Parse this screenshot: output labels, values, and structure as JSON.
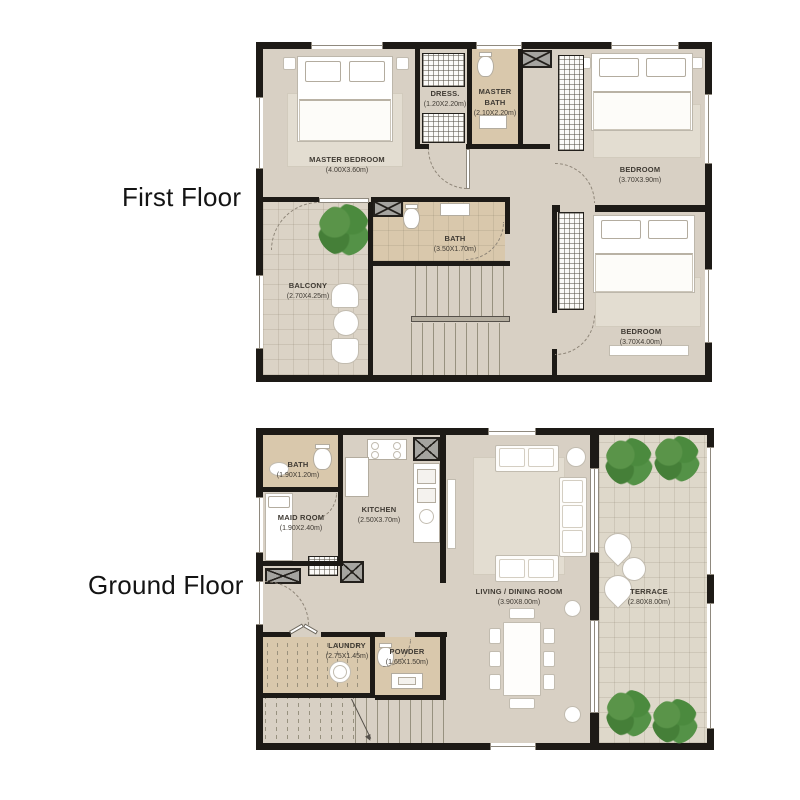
{
  "page": {
    "background": "#ffffff"
  },
  "colors": {
    "wall": "#1d1a16",
    "floor": "#d8d0c4",
    "tan": "#d9c8ac",
    "terr": "#ded8ca",
    "rug": "#e3ddd1",
    "plant": "#4c8a3c",
    "label": "#3f3a33",
    "title": "#141414"
  },
  "first_floor": {
    "title": "First Floor",
    "rooms": [
      {
        "name": "MASTER BEDROOM",
        "dims": "(4.00X3.60m)"
      },
      {
        "name": "DRESS.",
        "dims": "(1.20X2.20m)"
      },
      {
        "name": "MASTER BATH",
        "dims": "(2.10X2.20m)"
      },
      {
        "name": "BEDROOM",
        "dims": "(3.70X3.90m)"
      },
      {
        "name": "BATH",
        "dims": "(3.50X1.70m)"
      },
      {
        "name": "BALCONY",
        "dims": "(2.70X4.25m)"
      },
      {
        "name": "BEDROOM",
        "dims": "(3.70X4.00m)"
      }
    ]
  },
  "ground_floor": {
    "title": "Ground Floor",
    "rooms": [
      {
        "name": "BATH",
        "dims": "(1.90X1.20m)"
      },
      {
        "name": "MAID ROOM",
        "dims": "(1.90X2.40m)"
      },
      {
        "name": "KITCHEN",
        "dims": "(2.50X3.70m)"
      },
      {
        "name": "LIVING / DINING ROOM",
        "dims": "(3.90X8.00m)"
      },
      {
        "name": "TERRACE",
        "dims": "(2.80X8.00m)"
      },
      {
        "name": "LAUNDRY",
        "dims": "(2.75X1.45m)"
      },
      {
        "name": "POWDER",
        "dims": "(1.65X1.50m)"
      }
    ]
  }
}
